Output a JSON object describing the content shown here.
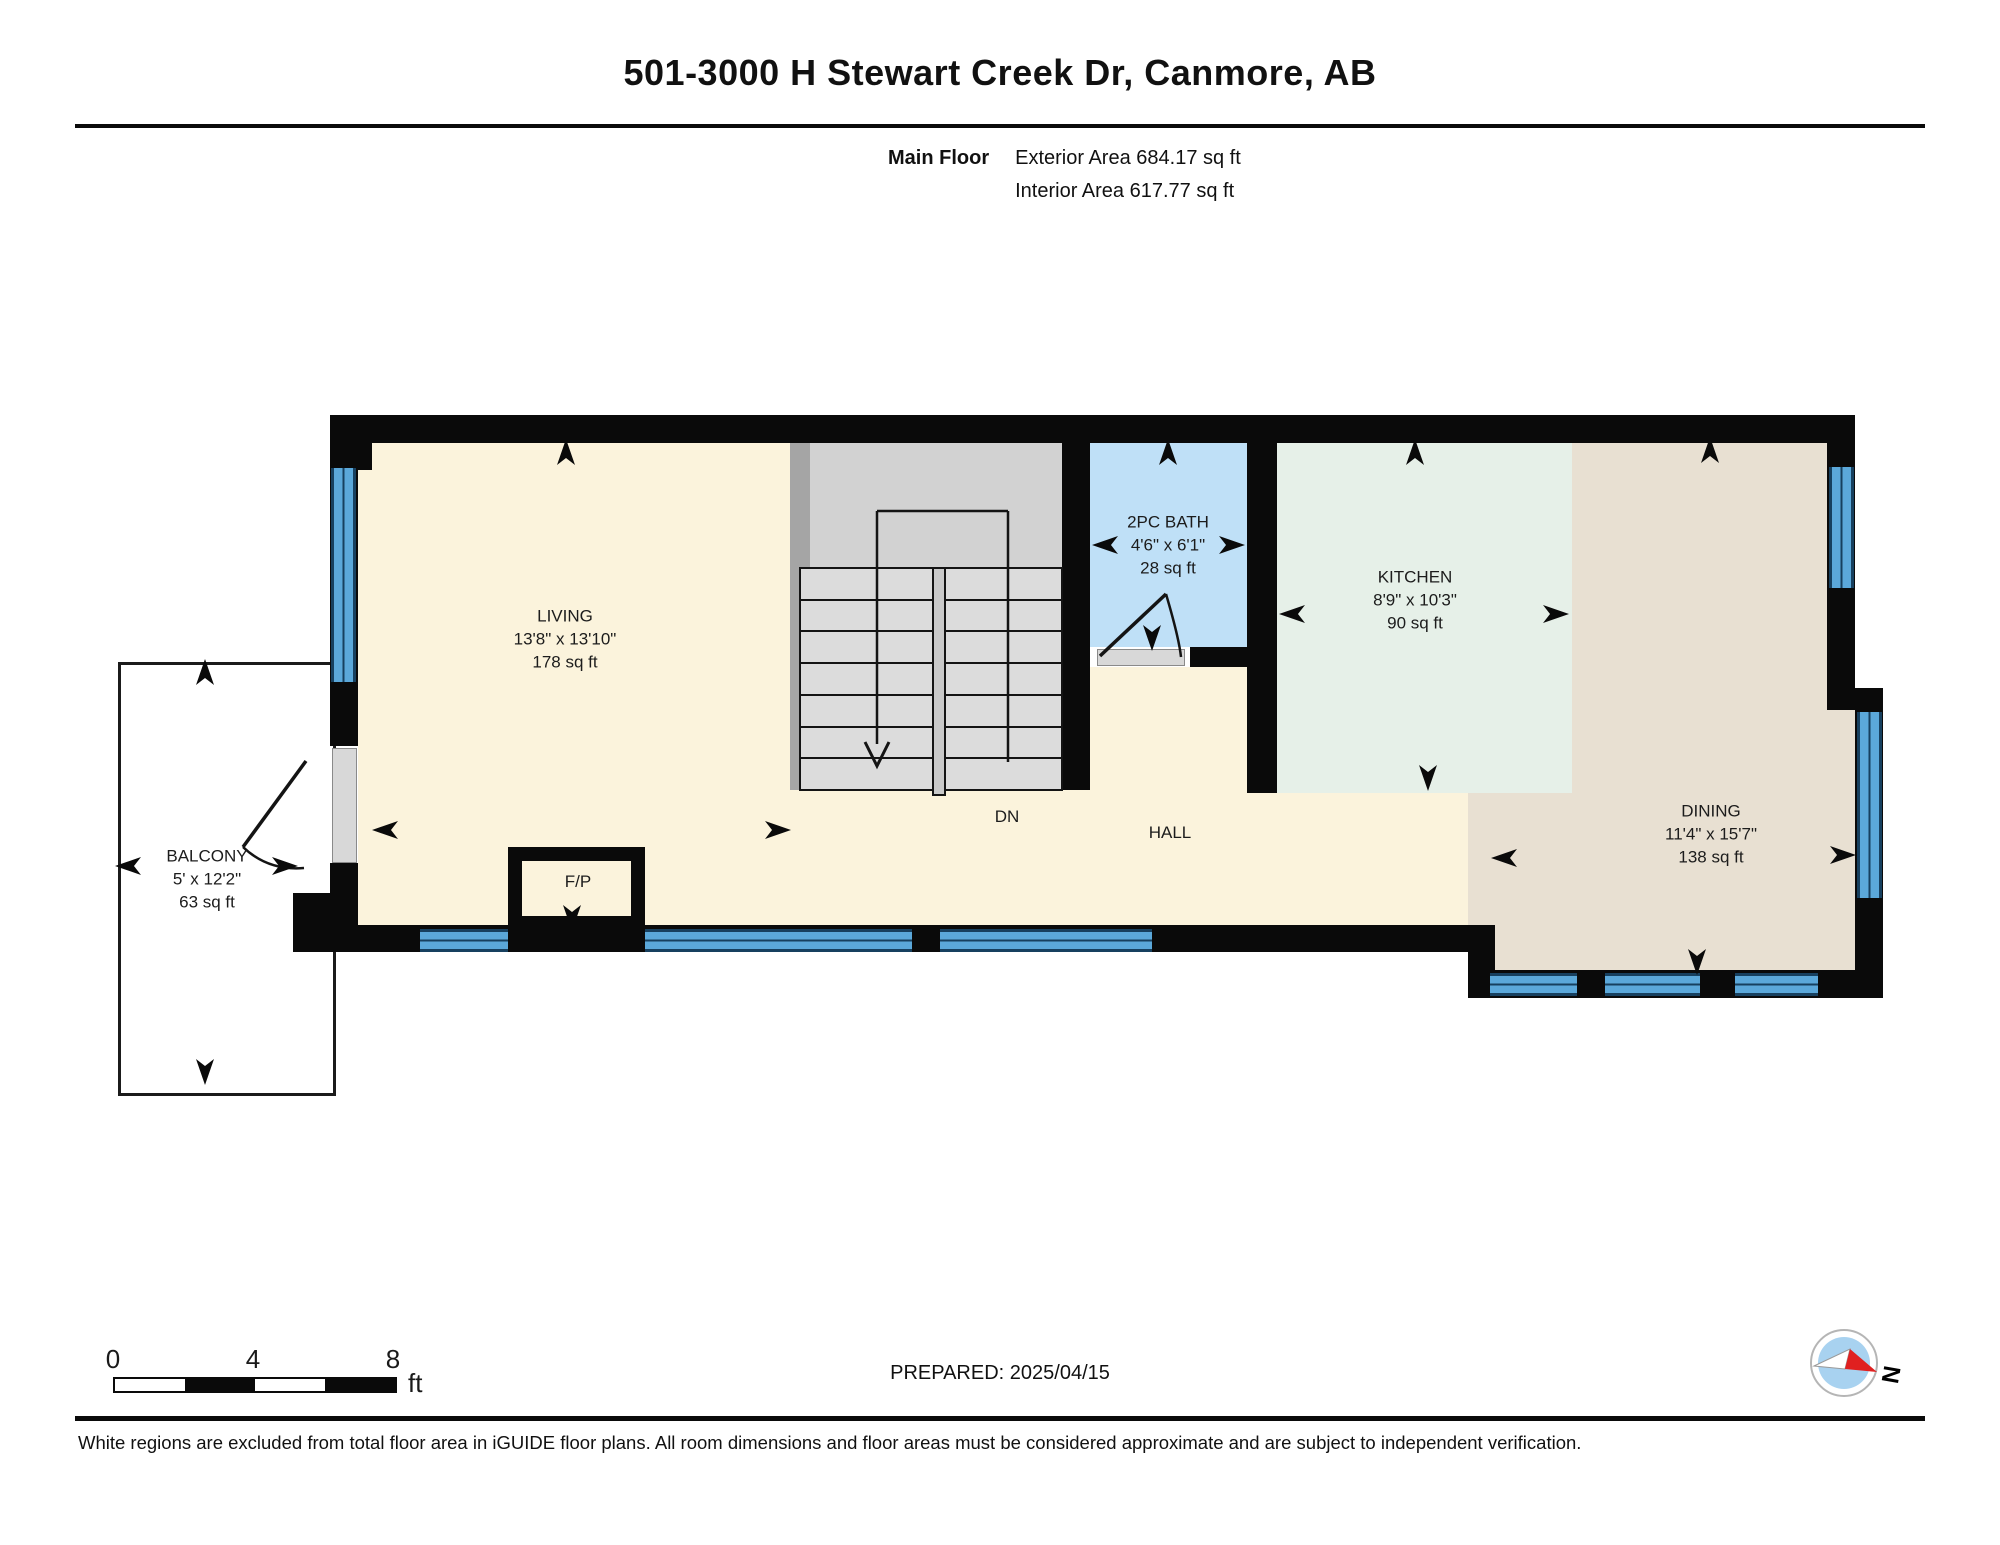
{
  "header": {
    "title": "501-3000 H Stewart Creek Dr, Canmore, AB",
    "floor_label": "Main Floor",
    "exterior_area": "Exterior Area 684.17 sq ft",
    "interior_area": "Interior Area 617.77 sq ft"
  },
  "rooms": [
    {
      "name": "LIVING",
      "dims": "13'8\" x 13'10\"",
      "area": "178 sq ft"
    },
    {
      "name": "2PC BATH",
      "dims": "4'6\" x 6'1\"",
      "area": "28 sq ft"
    },
    {
      "name": "KITCHEN",
      "dims": "8'9\" x 10'3\"",
      "area": "90 sq ft"
    },
    {
      "name": "DINING",
      "dims": "11'4\" x 15'7\"",
      "area": "138 sq ft"
    },
    {
      "name": "BALCONY",
      "dims": "5' x 12'2\"",
      "area": "63 sq ft"
    }
  ],
  "labels": {
    "hall": "HALL",
    "dn": "DN",
    "fp": "F/P"
  },
  "scale_bar": {
    "ticks": [
      "0",
      "4",
      "8"
    ],
    "unit": "ft"
  },
  "compass": {
    "label": "N"
  },
  "footer": {
    "prepared": "PREPARED: 2025/04/15",
    "disclaimer": "White regions are excluded from total floor area in iGUIDE floor plans. All room dimensions and floor areas must be considered approximate and are subject to independent verification."
  },
  "colors": {
    "living_hall": "#FBF3DC",
    "bath": "#BFE0F7",
    "kitchen": "#E6F0E8",
    "dining": "#E8E0D2",
    "stairs": "#D2D2D2",
    "window": "#5BA8DA",
    "wall": "#0A0A0A",
    "compass_needle": "#E02020"
  }
}
